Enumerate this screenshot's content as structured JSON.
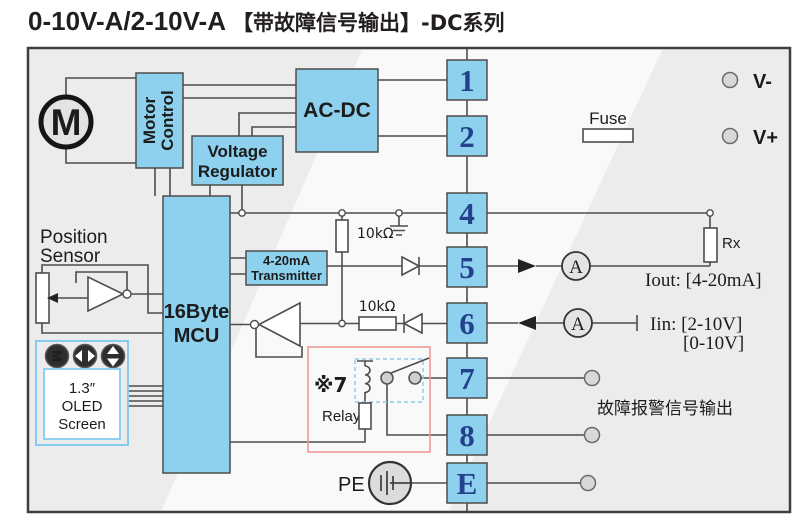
{
  "title": {
    "model": "0-10V-A/2-10V-A",
    "feature": "【带故障信号输出】",
    "series": "-DC系列"
  },
  "motor": {
    "letter": "M"
  },
  "blocks": {
    "motor_control": [
      "Motor",
      "Control"
    ],
    "voltage_regulator": [
      "Voltage",
      "Regulator"
    ],
    "ac_dc": "AC-DC",
    "mcu": [
      "16Byte",
      "MCU"
    ],
    "transmitter": [
      "4-20mA",
      "Transmitter"
    ]
  },
  "position_sensor": {
    "line1": "Position",
    "line2": "Sensor"
  },
  "oled": {
    "size": "1.3″",
    "line2": "OLED",
    "line3": "Screen"
  },
  "buttons": {
    "menu_glyph": "M"
  },
  "terminals": [
    "1",
    "2",
    "4",
    "5",
    "6",
    "7",
    "8",
    "E"
  ],
  "labels": {
    "v_minus": "V-",
    "v_plus": "V+",
    "fuse": "Fuse",
    "rx": "Rx",
    "pullup_resistor": "10kΩ",
    "series_resistor": "10kΩ",
    "iout": "Iout: [4-20mA]",
    "iin_line1": "Iin: [2-10V]",
    "iin_line2": "[0-10V]",
    "fault_output": "故障报警信号输出",
    "pe": "PE",
    "ammeter": "A"
  },
  "relay": {
    "note": "※7",
    "label": "Relay"
  },
  "colors": {
    "block_fill": "#8ed1ee",
    "terminal_number": "#23418c",
    "motor_orange": "#e2500a",
    "relay_box_border": "#f19999",
    "note_red": "#e23a3a",
    "oled_border": "#85cdf0",
    "wire": "#4d4d4d",
    "diagram_background": "#ececec"
  }
}
